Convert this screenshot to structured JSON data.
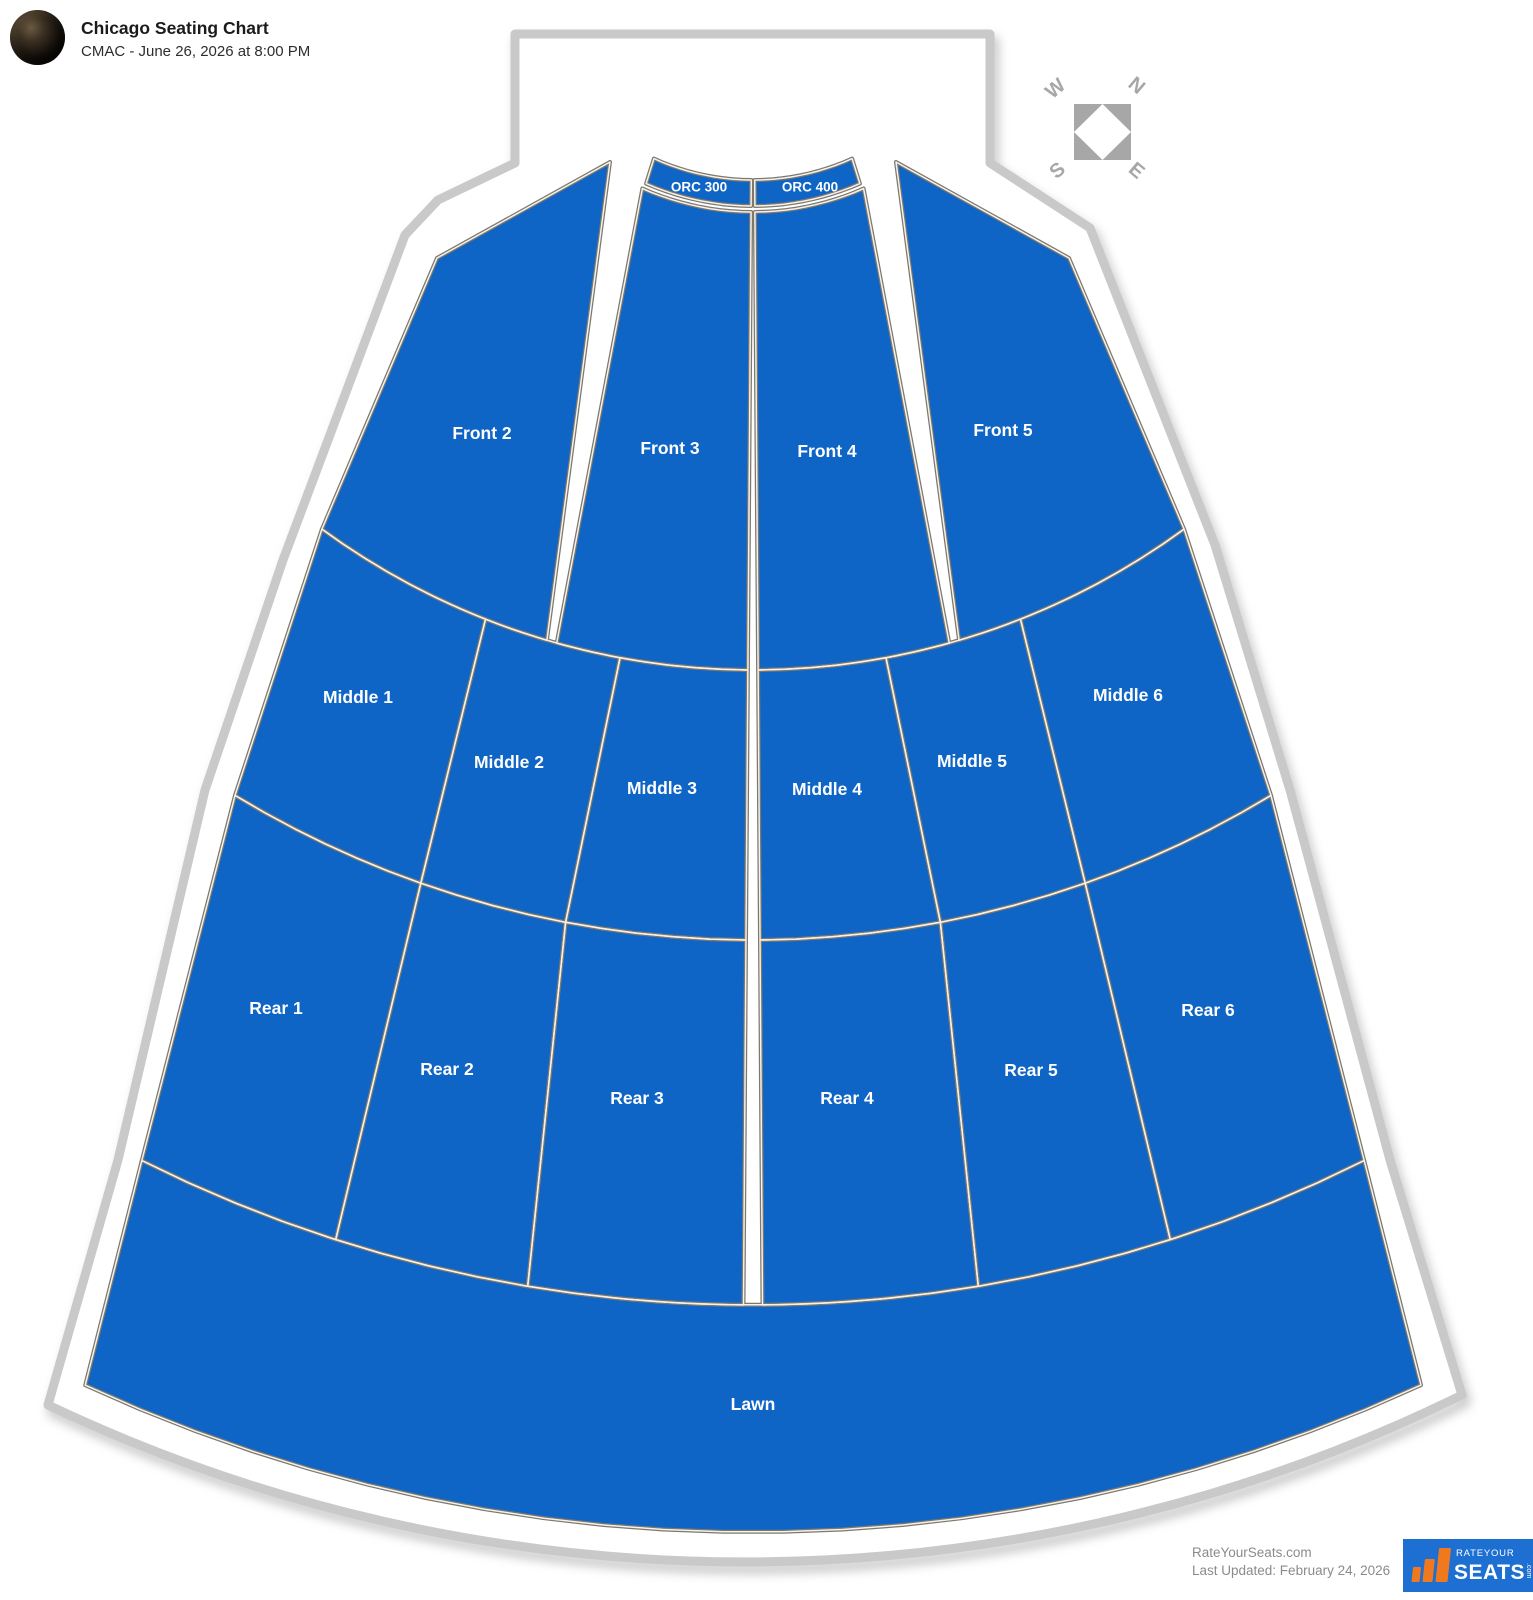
{
  "header": {
    "title": "Chicago Seating Chart",
    "subtitle": "CMAC - June 26, 2026 at 8:00 PM"
  },
  "compass": {
    "n": "N",
    "e": "E",
    "s": "S",
    "w": "W"
  },
  "sections": [
    {
      "id": "orc-300",
      "label": "ORC 300"
    },
    {
      "id": "orc-400",
      "label": "ORC 400"
    },
    {
      "id": "front-2",
      "label": "Front 2"
    },
    {
      "id": "front-3",
      "label": "Front 3"
    },
    {
      "id": "front-4",
      "label": "Front 4"
    },
    {
      "id": "front-5",
      "label": "Front 5"
    },
    {
      "id": "middle-1",
      "label": "Middle 1"
    },
    {
      "id": "middle-2",
      "label": "Middle 2"
    },
    {
      "id": "middle-3",
      "label": "Middle 3"
    },
    {
      "id": "middle-4",
      "label": "Middle 4"
    },
    {
      "id": "middle-5",
      "label": "Middle 5"
    },
    {
      "id": "middle-6",
      "label": "Middle 6"
    },
    {
      "id": "rear-1",
      "label": "Rear 1"
    },
    {
      "id": "rear-2",
      "label": "Rear 2"
    },
    {
      "id": "rear-3",
      "label": "Rear 3"
    },
    {
      "id": "rear-4",
      "label": "Rear 4"
    },
    {
      "id": "rear-5",
      "label": "Rear 5"
    },
    {
      "id": "rear-6",
      "label": "Rear 6"
    },
    {
      "id": "lawn",
      "label": "Lawn"
    }
  ],
  "footer": {
    "site": "RateYourSeats.com",
    "updated": "Last Updated: February 24, 2026",
    "logo_top": "RATEYOUR",
    "logo_main": "SEATS",
    "logo_dotcom": ".com"
  },
  "colors": {
    "section_fill": "#0f65c5",
    "section_edge_dark": "#7d786e",
    "section_edge_light": "#f4f2ec",
    "wall": "#c9c9c9",
    "compass": "#a7a7a7",
    "logo_bg": "#1d6fd2",
    "logo_accent": "#f0791f"
  }
}
